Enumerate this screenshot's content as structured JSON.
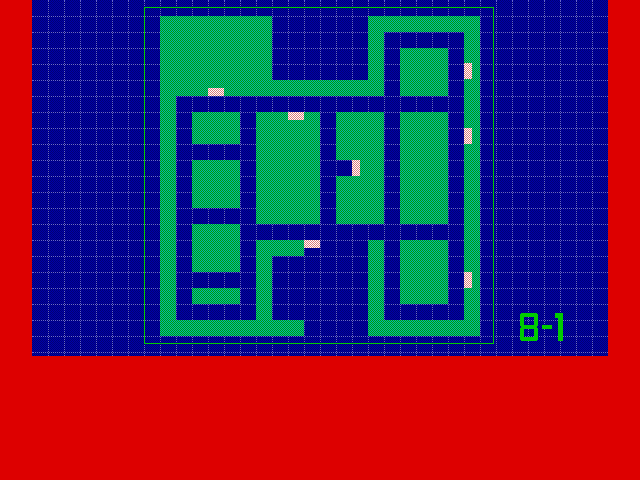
{
  "screen": {
    "width": 640,
    "height": 480,
    "bg_color": "#dd0000"
  },
  "map_field": {
    "x": 32,
    "y": 0,
    "width": 576,
    "height": 356,
    "dither_colors": [
      "#0000a8",
      "#000074"
    ],
    "grid_line_color": "#7878d8",
    "grid_spacing": 16
  },
  "maze": {
    "origin_x": 144,
    "origin_y": 0,
    "tile_size": 16,
    "floor_dither_colors": [
      "#00b4b4",
      "#00a000"
    ],
    "door_dither_colors": [
      "#ffffff",
      "#d97979"
    ],
    "border": {
      "x": 144,
      "y": 7,
      "width": 350,
      "height": 337,
      "color": "#00cc00",
      "thickness": 1
    },
    "rows": [
      "......................",
      ".#######......#######.",
      ".#######......#.....#.",
      ".#######......#.###.#.",
      ".#######......#.###.#.",
      ".##############.###.#.",
      ".#..................#.",
      ".#.###.####.###.###.#.",
      ".#.###.####.###.###.#.",
      ".#.....####.###.###.#.",
      ".#.###.####..##.###.#.",
      ".#.###.####.###.###.#.",
      ".#.###.####.###.###.#.",
      ".#.....####.###.###.#.",
      ".#.###..............#.",
      ".#.###.###....#.###.#.",
      ".#.###.#......#.###.#.",
      ".#.....#......#.###.#.",
      ".#.###.#......#.###.#.",
      ".#.....#......#.....#.",
      ".#########....#######.",
      "......................"
    ],
    "doors": [
      {
        "x": 208,
        "y": 88,
        "width": 16,
        "height": 8
      },
      {
        "x": 288,
        "y": 112,
        "width": 16,
        "height": 8
      },
      {
        "x": 464,
        "y": 63,
        "width": 8,
        "height": 16
      },
      {
        "x": 352,
        "y": 160,
        "width": 8,
        "height": 16
      },
      {
        "x": 464,
        "y": 128,
        "width": 8,
        "height": 16
      },
      {
        "x": 304,
        "y": 240,
        "width": 16,
        "height": 8
      },
      {
        "x": 464,
        "y": 272,
        "width": 8,
        "height": 16
      }
    ]
  },
  "level_label": {
    "text": "B-1",
    "x": 520,
    "y": 313,
    "color": "#00cc00"
  }
}
